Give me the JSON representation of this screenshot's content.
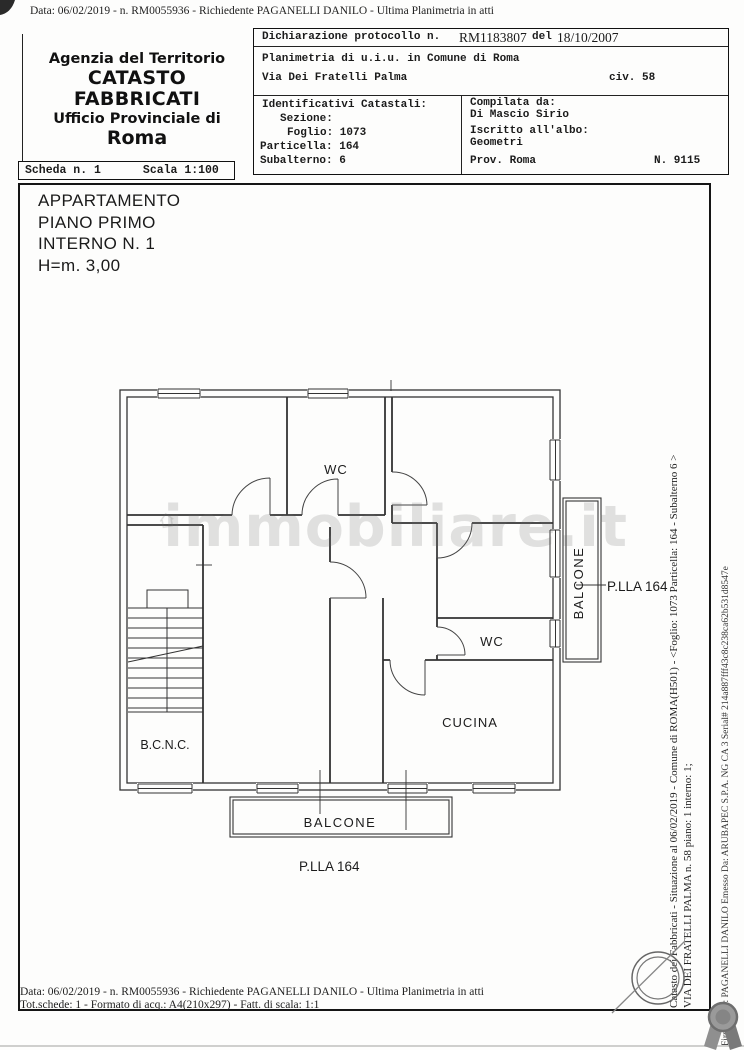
{
  "page": {
    "header_line": "Data: 06/02/2019 -  n. RM0055936 - Richiedente PAGANELLI DANILO - Ultima Planimetria in atti",
    "footer_line1": "Data: 06/02/2019 -  n. RM0055936 - Richiedente PAGANELLI DANILO - Ultima Planimetria in atti",
    "footer_line2": "Tot.schede: 1 - Formato di acq.: A4(210x297) - Fatt. di scala: 1:1"
  },
  "agency": {
    "line1": "Agenzia del Territorio",
    "line2": "CATASTO FABBRICATI",
    "line3": "Ufficio Provinciale di",
    "line4": "Roma"
  },
  "scheda": {
    "scheda": "Scheda n. 1",
    "scala": "Scala 1:100"
  },
  "declaration": {
    "protocol_label": "Dichiarazione protocollo n.",
    "protocol_number": "RM1183807",
    "del_label": "del",
    "protocol_date": "18/10/2007",
    "line2": "Planimetria di u.i.u. in Comune di Roma",
    "street": "Via Dei Fratelli Palma",
    "civ": "civ. 58"
  },
  "catasto_ids": {
    "title": "Identificativi Catastali:",
    "sezione": "Sezione:",
    "foglio": "Foglio: 1073",
    "particella": "Particella: 164",
    "subalterno": "Subalterno: 6"
  },
  "compiler": {
    "label": "Compilata da:",
    "name": "Di Mascio Sirio",
    "albo_label": "Iscritto all'albo:",
    "albo": "Geometri",
    "prov": "Prov. Roma",
    "number": "N. 9115"
  },
  "apartment": {
    "line1": "APPARTAMENTO",
    "line2": "PIANO PRIMO",
    "line3": "INTERNO N. 1",
    "line4": "H=m. 3,00"
  },
  "plan_labels": {
    "wc_top": "WC",
    "wc_mid": "WC",
    "cucina": "CUCINA",
    "bcnc": "B.C.N.C.",
    "balcone_right": "BALCONE",
    "balcone_bottom": "BALCONE",
    "plla_right": "P.LLA 164",
    "plla_bottom": "P.LLA 164"
  },
  "watermark": "immobiliare.it",
  "side_text": {
    "inner_line1": "Catasto dei Fabbricati - Situazione al 06/02/2019 - Comune di ROMA(H501) - <Foglio: 1073 Particella: 164 - Subalterno 6 >",
    "inner_line2": "VIA DEI FRATELLI PALMA n. 58 piano: 1 interno: 1;",
    "outer": "Firmato Da: PAGANELLI DANILO Emesso Da: ARUBAPEC S.P.A. NG CA 3 Serial# 214a887fff43c8c238ca62b531d8547e"
  },
  "colors": {
    "ink": "#1e1e1e",
    "watermark_gray": "#6e6e6e",
    "seal_gray": "#8a8a8a"
  }
}
